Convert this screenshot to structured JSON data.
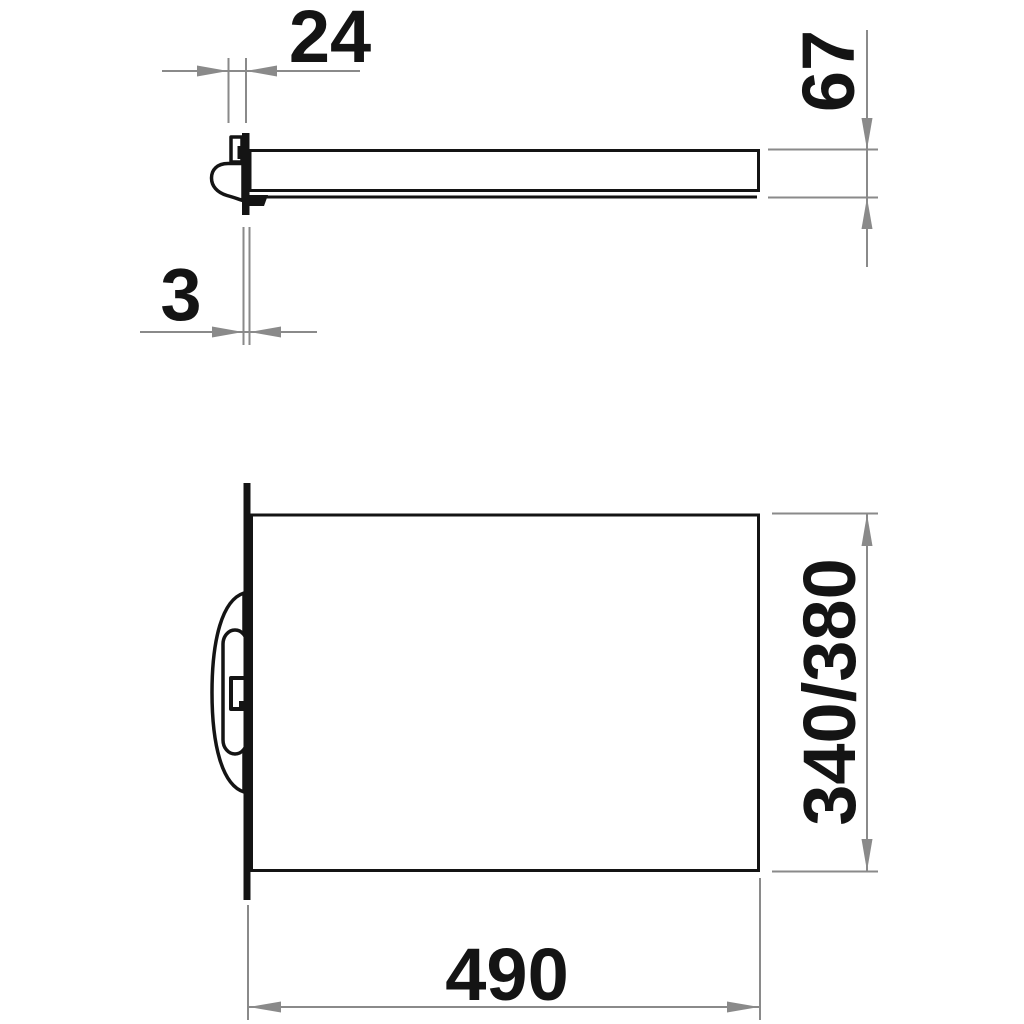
{
  "colors": {
    "line": "#141414",
    "dimension": "#8a8a8a",
    "background": "#ffffff"
  },
  "dimensions": {
    "bracket_depth": {
      "label": "24"
    },
    "plate_thickness": {
      "label": "3"
    },
    "profile_height": {
      "label": "67"
    },
    "shelf_depth": {
      "label": "340/380"
    },
    "shelf_width": {
      "label": "490"
    }
  }
}
